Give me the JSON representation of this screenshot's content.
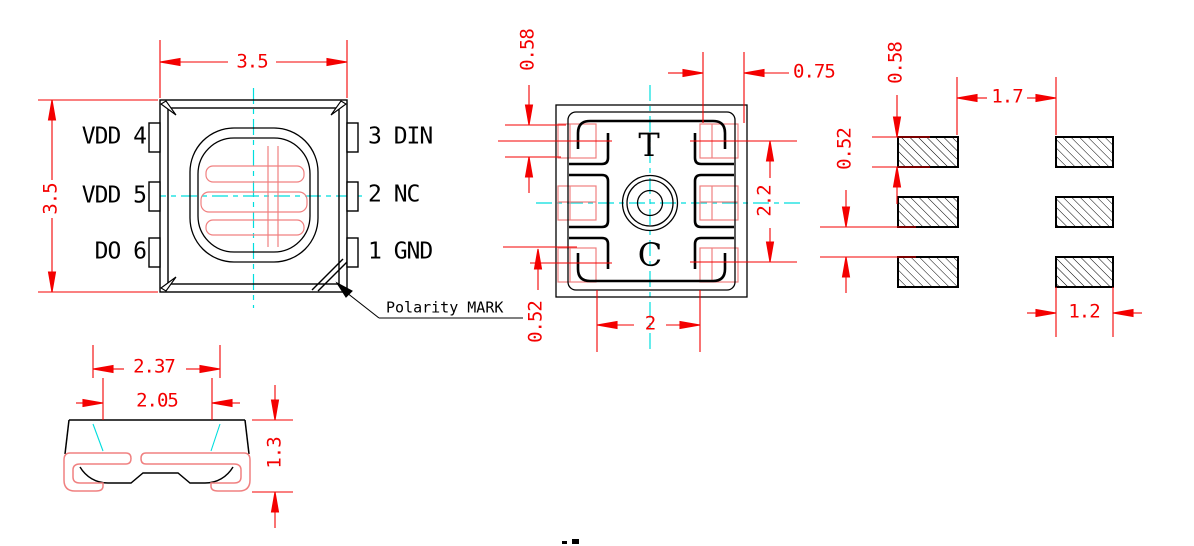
{
  "title": "SMD LED package outline drawing",
  "colors": {
    "dimension": "#f40000",
    "outline": "#000000",
    "centerline": "#00dede",
    "pad_overlay": "#f08080"
  },
  "views": {
    "top": {
      "width": "3.5",
      "height": "3.5",
      "pins_left": [
        "VDD 4",
        "VDD 5",
        "DO 6"
      ],
      "pins_right": [
        "3 DIN",
        "2 NC",
        "1 GND"
      ],
      "polarity": "Polarity MARK"
    },
    "bottom": {
      "mark_top": "T",
      "mark_bottom": "C",
      "pad_height": "0.58",
      "pad_width": "0.75",
      "row_span": "2.2",
      "pad_offset": "0.52",
      "inner_width": "2"
    },
    "footprint": {
      "pad_height": "0.58",
      "row_gap": "0.52",
      "col_gap": "1.7",
      "pad_width": "1.2"
    },
    "side": {
      "outer_width": "2.37",
      "inner_width": "2.05",
      "height": "1.3"
    }
  }
}
